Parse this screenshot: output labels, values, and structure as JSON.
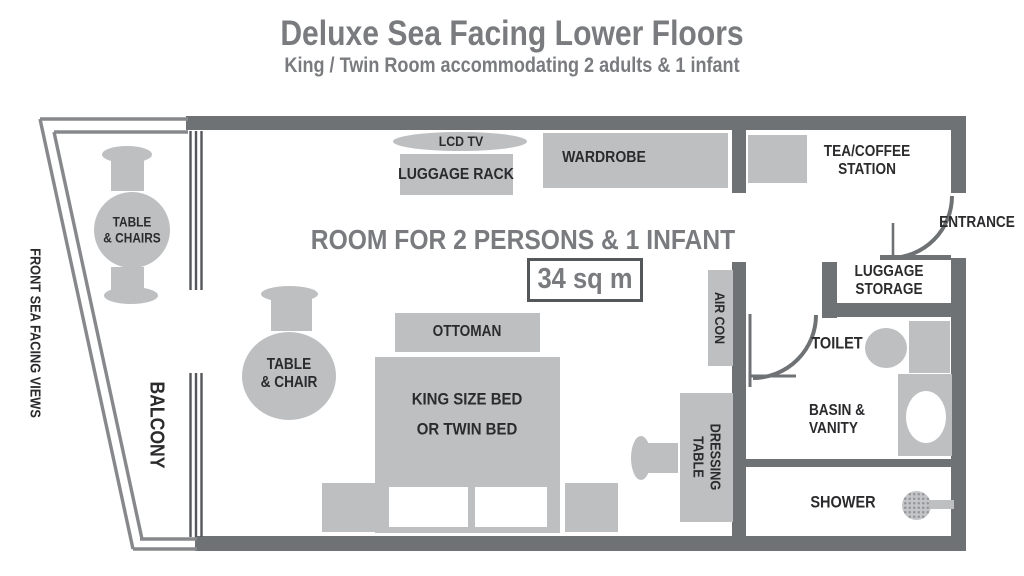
{
  "header": {
    "title": "Deluxe Sea Facing Lower Floors",
    "subtitle": "King / Twin Room accommodating 2 adults & 1 infant"
  },
  "plan": {
    "room_capacity_label": "ROOM FOR 2 PERSONS & 1 INFANT",
    "area_label": "34 sq m",
    "exterior_labels": {
      "front_sea_facing_views": "FRONT SEA FACING VIEWS",
      "balcony": "BALCONY"
    },
    "furniture_labels": {
      "lcd_tv": "LCD TV",
      "luggage_rack": "LUGGAGE RACK",
      "wardrobe": "WARDROBE",
      "tea_coffee_station": "TEA/COFFEE\nSTATION",
      "ottoman": "OTTOMAN",
      "bed": "KING SIZE BED\nOR TWIN BED",
      "dressing_table": "DRESSING\nTABLE",
      "air_con": "AIR CON",
      "balcony_table": "TABLE\n& CHAIRS",
      "room_table": "TABLE\n& CHAIR"
    },
    "room_labels": {
      "entrance": "ENTRANCE",
      "luggage_storage": "LUGGAGE\nSTORAGE",
      "toilet": "TOILET",
      "basin_vanity": "BASIN &\nVANITY",
      "shower": "SHOWER"
    }
  },
  "colors": {
    "wall": "#6f7274",
    "furniture": "#bdbfc1",
    "title_gray": "#797b7e",
    "label_black": "#2b2b2d",
    "rail": "#86888b",
    "slider": "#54565a"
  }
}
